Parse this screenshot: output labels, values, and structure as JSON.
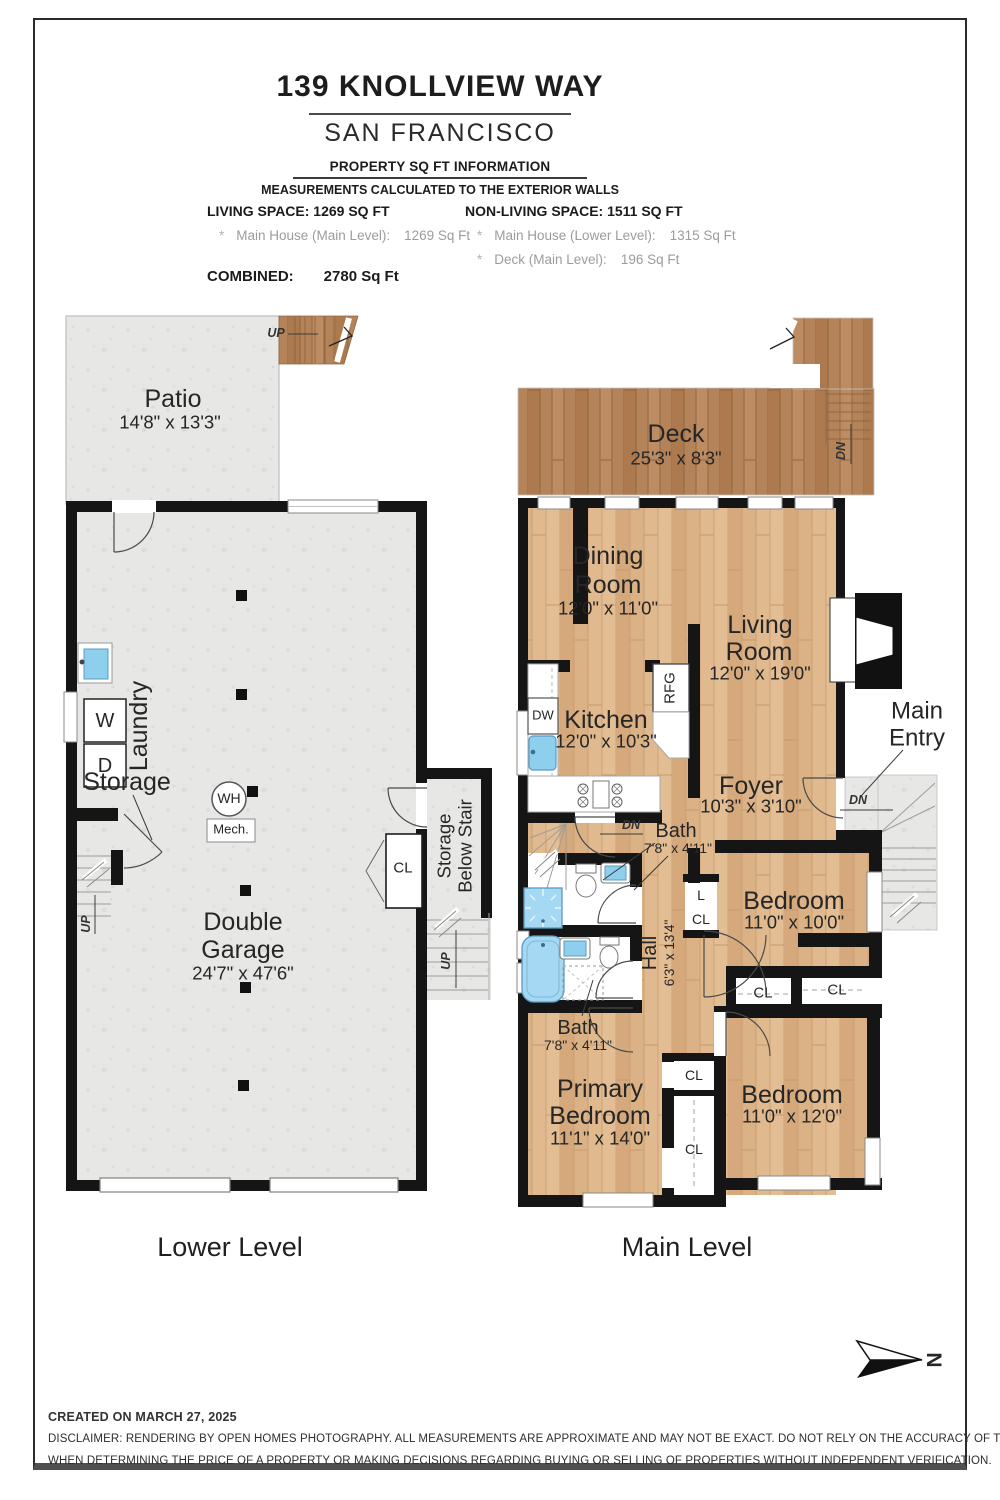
{
  "header": {
    "title": "139 KNOLLVIEW WAY",
    "city": "SAN FRANCISCO",
    "section_title": "PROPERTY SQ FT INFORMATION",
    "subtitle": "MEASUREMENTS CALCULATED TO THE EXTERIOR WALLS",
    "living_heading": "LIVING SPACE: 1269 SQ FT",
    "living_items": [
      {
        "bullet": "*",
        "label": "Main House (Main Level):",
        "value": "1269 Sq Ft"
      }
    ],
    "nonliving_heading": "NON-LIVING SPACE: 1511 SQ FT",
    "nonliving_items": [
      {
        "bullet": "*",
        "label": "Main House (Lower Level):",
        "value": "1315 Sq Ft"
      },
      {
        "bullet": "*",
        "label": "Deck (Main Level):",
        "value": "196 Sq Ft"
      }
    ],
    "combined_label": "COMBINED:",
    "combined_value": "2780  Sq Ft"
  },
  "lower_level": {
    "caption": "Lower Level",
    "patio": {
      "name": "Patio",
      "dims": "14'8\" x 13'3\""
    },
    "garage": {
      "line1": "Double",
      "line2": "Garage",
      "dims": "24'7\" x 47'6\""
    },
    "laundry": "Laundry",
    "storage": "Storage",
    "storage_below_stair": {
      "line1": "Storage",
      "line2": "Below Stair"
    },
    "labels": {
      "washer": "W",
      "dryer": "D",
      "water_heater": "WH",
      "mech": "Mech.",
      "closet": "CL",
      "up": "UP"
    }
  },
  "main_level": {
    "caption": "Main Level",
    "deck": {
      "name": "Deck",
      "dims": "25'3\" x 8'3\""
    },
    "dining": {
      "line1": "Dining",
      "line2": "Room",
      "dims": "12'0\" x 11'0\""
    },
    "living": {
      "line1": "Living",
      "line2": "Room",
      "dims": "12'0\" x 19'0\""
    },
    "kitchen": {
      "name": "Kitchen",
      "dims": "12'0\" x 10'3\""
    },
    "foyer": {
      "name": "Foyer",
      "dims": "10'3\" x 3'10\""
    },
    "bath": {
      "name": "Bath",
      "dims": "7'8\" x 4'11\""
    },
    "hall": {
      "name": "Hall",
      "dims": "6'3\" x 13'4\""
    },
    "bedroom1": {
      "name": "Bedroom",
      "dims": "11'0\" x 10'0\""
    },
    "bedroom2": {
      "name": "Bedroom",
      "dims": "11'0\" x 12'0\""
    },
    "primary": {
      "line1": "Primary",
      "line2": "Bedroom",
      "dims": "11'1\" x 14'0\""
    },
    "main_entry": {
      "line1": "Main",
      "line2": "Entry"
    },
    "labels": {
      "dn": "DN",
      "up": "UP",
      "closet": "CL",
      "linen": "L",
      "fireplace": "FP",
      "refrigerator": "RFG",
      "dishwasher": "DW"
    }
  },
  "compass": {
    "letter": "N"
  },
  "footer": {
    "created": "CREATED ON MARCH 27, 2025",
    "disclaimer_line1": "DISCLAIMER: RENDERING BY OPEN HOMES PHOTOGRAPHY. ALL MEASUREMENTS ARE APPROXIMATE AND MAY NOT BE EXACT. DO NOT RELY ON THE ACCURACY OF THIS FLOOR PLAN",
    "disclaimer_line2": "WHEN DETERMINING THE PRICE OF A PROPERTY OR MAKING DECISIONS REGARDING BUYING OR SELLING OF PROPERTIES WITHOUT INDEPENDENT VERIFICATION."
  },
  "colors": {
    "wall": "#151515",
    "wood": "#dbb286",
    "deck_wood": "#b5835a",
    "concrete": "#e7e8e6",
    "fixture_blue": "#9fd6f2"
  }
}
